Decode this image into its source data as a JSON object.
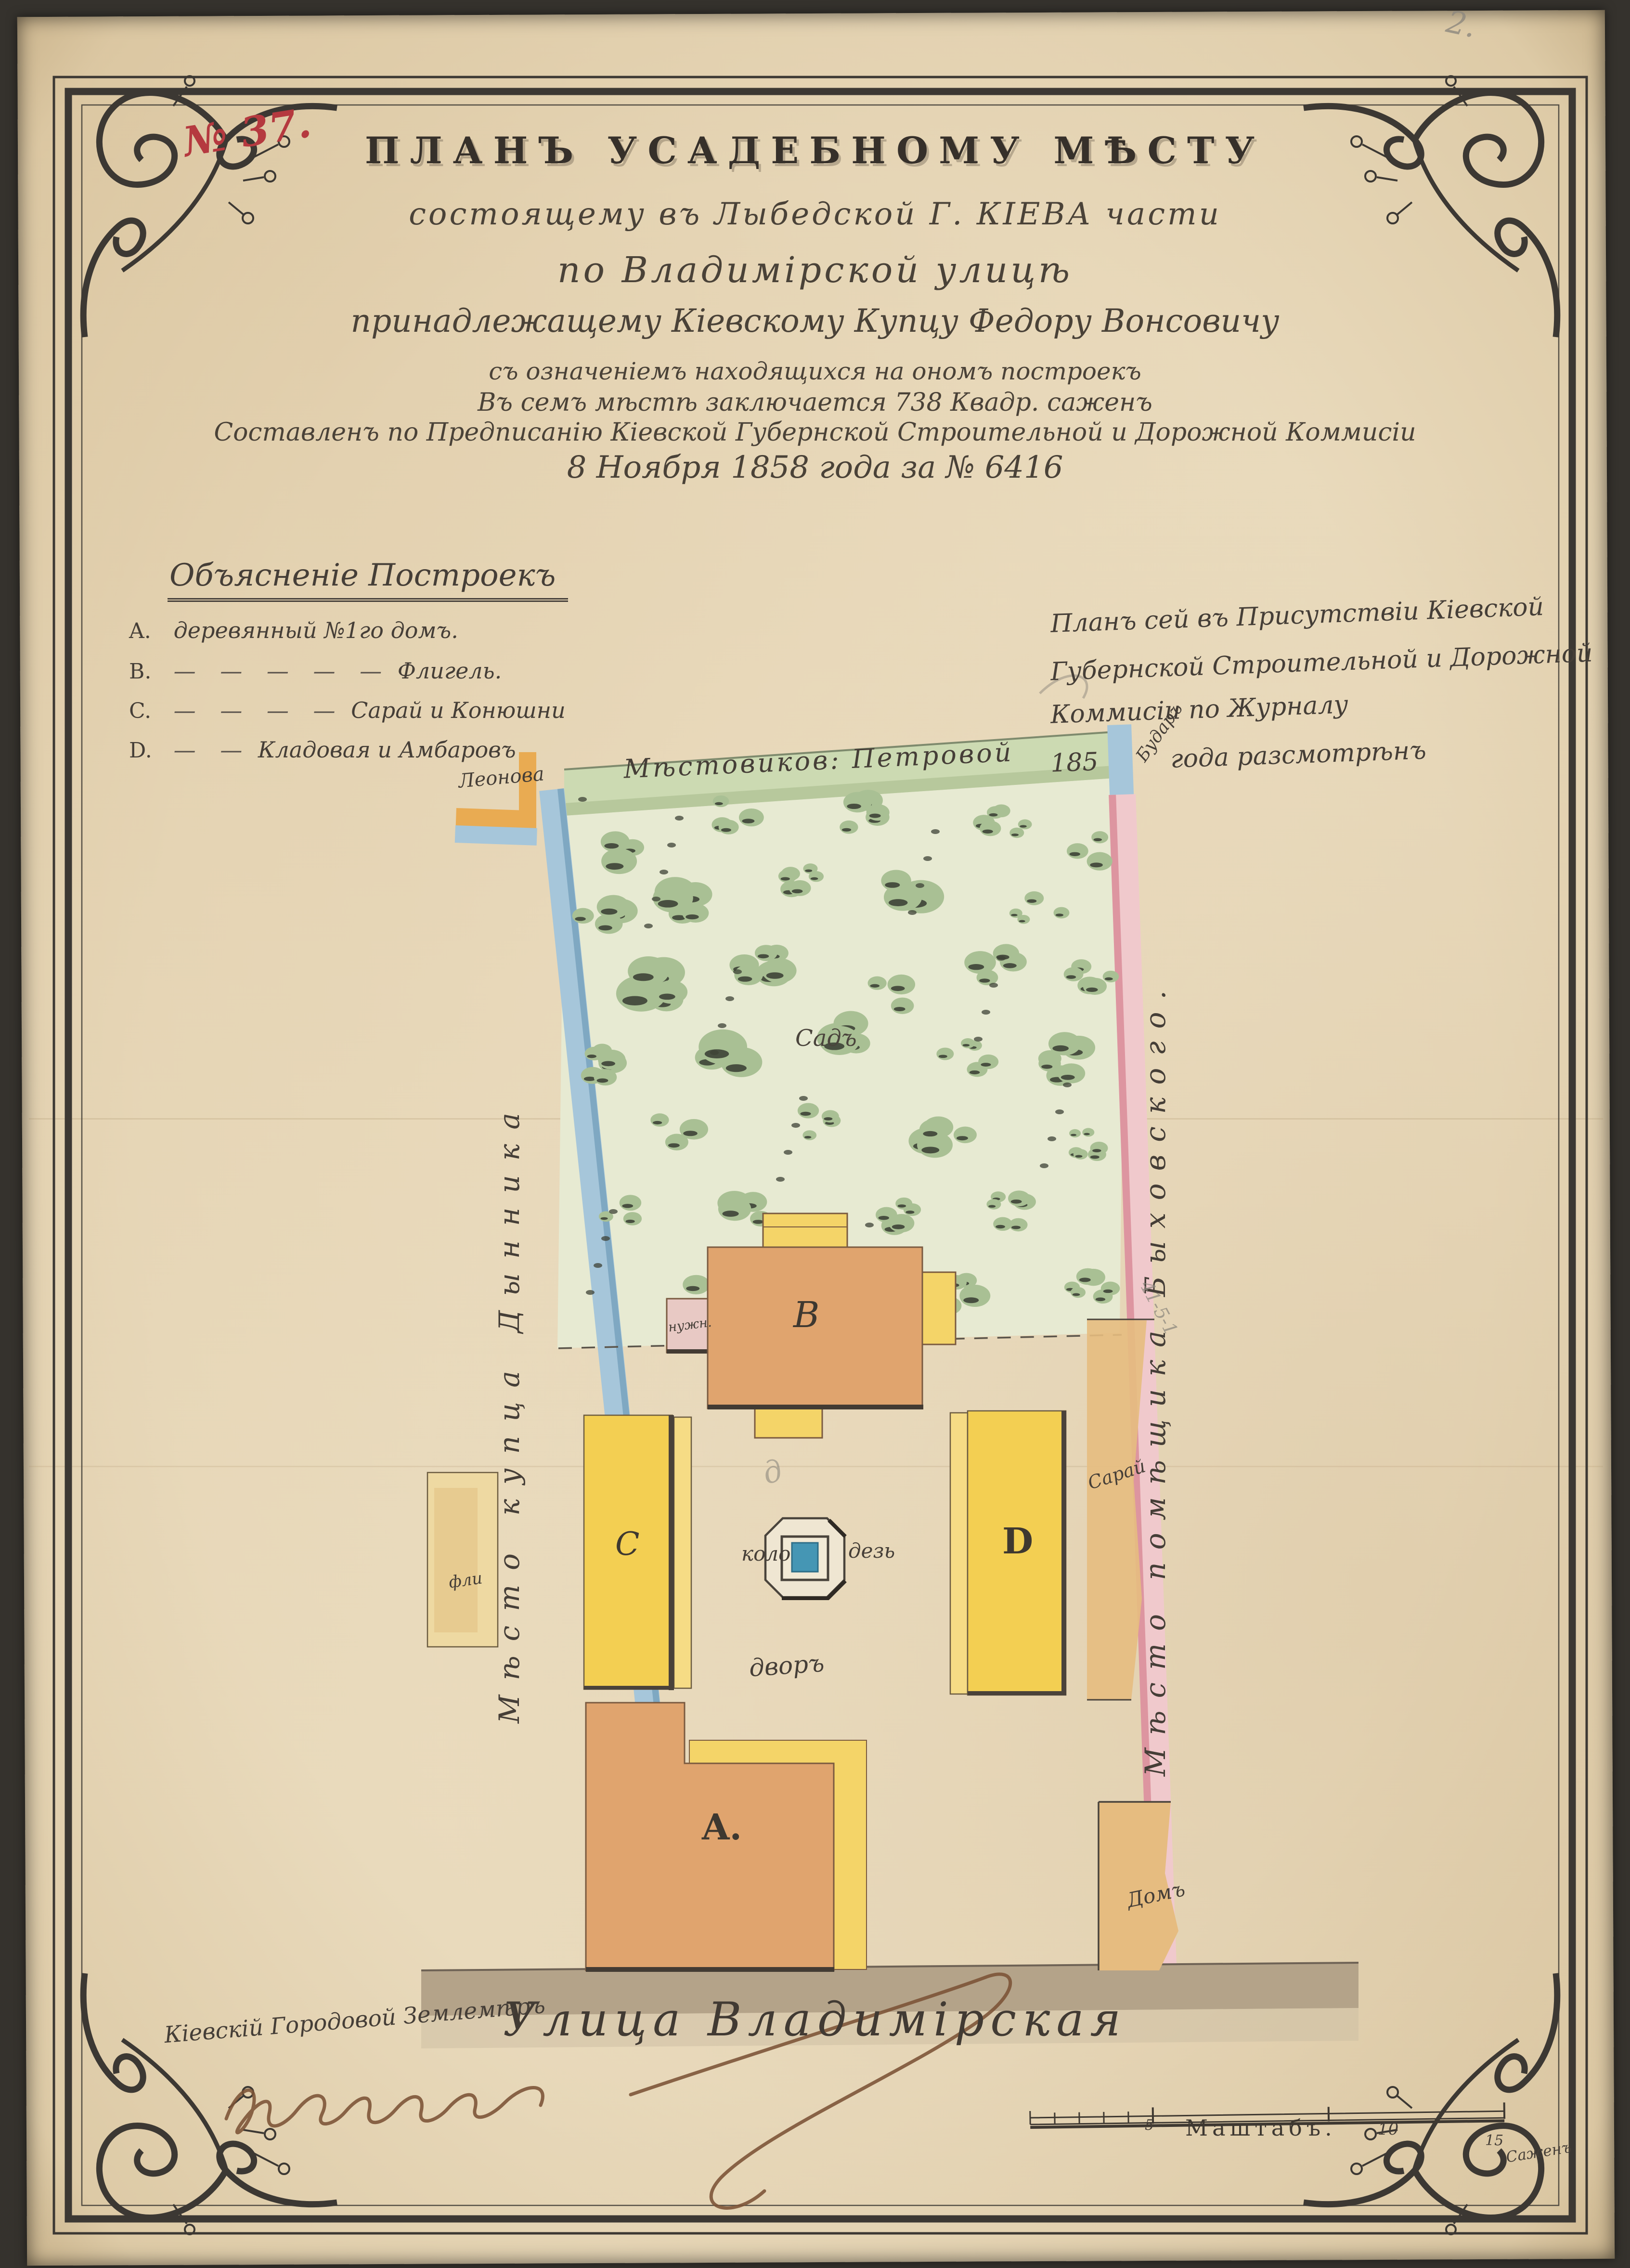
{
  "sheet": {
    "doc_number": "№ 37.",
    "page_number_pencil": "2."
  },
  "header": {
    "title": "ПЛАНЪ УСАДЕБНОМУ МѢСТУ",
    "subtitle_lines": [
      "состоящему въ Лыбедской Г. КІЕВА части",
      "по Владимірской улицѣ",
      "принадлежащему Кіевскому Купцу Федору Вонсовичу",
      "съ означеніемъ находящихся на ономъ построекъ",
      "Въ семъ мѣстѣ заключается 738 Квадр. саженъ",
      "Составленъ по Предписанію Кіевской Губернской Строительной и Дорожной Коммисіи",
      "8 Ноября 1858 года за № 6416"
    ]
  },
  "legend": {
    "heading": "Объясненіе Построекъ",
    "items": [
      {
        "key": "A.",
        "dashes": "",
        "label": "деревянный №1го домъ."
      },
      {
        "key": "B.",
        "dashes": "— — — — —",
        "label": "Флигель."
      },
      {
        "key": "C.",
        "dashes": "— — — —",
        "label": "Сарай и Конюшни"
      },
      {
        "key": "D.",
        "dashes": "— —",
        "label": "Кладовая и Амбаровъ"
      }
    ]
  },
  "approval": {
    "lines": [
      "Планъ сей въ Присутствіи Кіевской",
      "Губернской Строительной и Дорожной",
      "Коммисіи по Журналу"
    ],
    "year_prefix": "185",
    "year_suffix": "года разсмотрѣнъ"
  },
  "plan": {
    "north_label": "Мѣстовиков: Петровой",
    "west_label": "Мѣсто купца Дынника",
    "east_label": "Мѣсто помѣщика Быховского.",
    "neighbor_note": "Леонова",
    "corner_note": "Бударъ",
    "garden_label": "Садъ",
    "yard_label": "дворъ",
    "well_label_left": "коло",
    "well_label_right": "дезь",
    "buildings": {
      "a": "A.",
      "b": "B",
      "c": "C",
      "d": "D"
    },
    "annex_label": "нужн.",
    "east_shed_label": "Сарай",
    "east_house_label": "Домъ",
    "outside_west_label": "фли",
    "street_label": "Улица Владимірская"
  },
  "footer": {
    "surveyor_title": "Кіевскій Городовой Землемѣръ",
    "scale": {
      "title": "Маштабъ.",
      "tick_5": "5",
      "tick_10": "10",
      "tick_15": "15",
      "unit": "Саженъ"
    }
  },
  "pencil_notes": {
    "diagonal": "41-5-1",
    "near_well": "д"
  },
  "colors": {
    "paper": "#eadcc0",
    "ink": "#453e37",
    "number_red": "#b5393f",
    "garden_green": "#a9c094",
    "band_blue": "#a6c6da",
    "band_pink": "#f0c9cc",
    "building_yellow": "#f3cf52",
    "building_salmon": "#e0a46e",
    "neighbor_tan": "#e6bc80",
    "well_blue": "#4596b4",
    "street_grey": "#b4a389"
  }
}
